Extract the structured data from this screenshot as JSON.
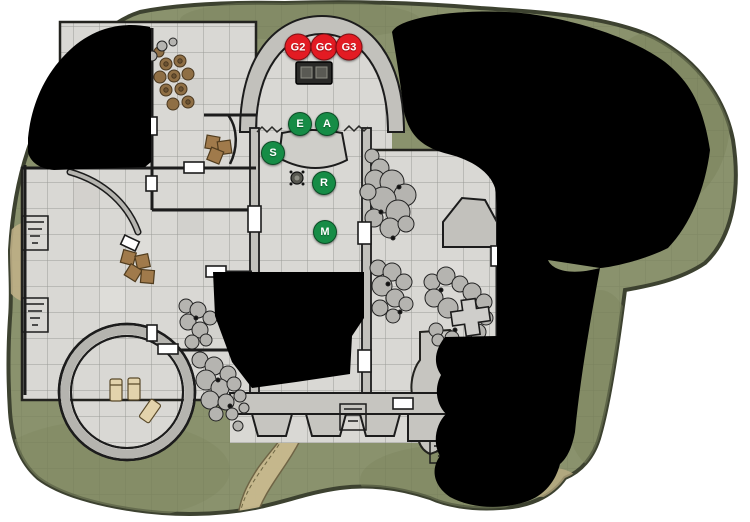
{
  "map": {
    "kind": "vtt-battle-map",
    "colors": {
      "fog": "#000000",
      "grass": "#8a926d",
      "stone": "#d9d8d4",
      "wall": "#1c1c1c",
      "trail": "#c9ba8f",
      "enemy_token": "#e31b23",
      "party_token": "#168c46"
    },
    "tokens": {
      "list": [
        {
          "label": "G2",
          "x": 298,
          "y": 47,
          "d": 25,
          "color": "#e31b23"
        },
        {
          "label": "GC",
          "x": 324,
          "y": 47,
          "d": 25,
          "color": "#e31b23"
        },
        {
          "label": "G3",
          "x": 349,
          "y": 47,
          "d": 25,
          "color": "#e31b23"
        },
        {
          "label": "E",
          "x": 300,
          "y": 124,
          "d": 22,
          "color": "#168c46"
        },
        {
          "label": "A",
          "x": 327,
          "y": 124,
          "d": 22,
          "color": "#168c46"
        },
        {
          "label": "S",
          "x": 273,
          "y": 153,
          "d": 22,
          "color": "#168c46"
        },
        {
          "label": "R",
          "x": 324,
          "y": 183,
          "d": 22,
          "color": "#168c46"
        },
        {
          "label": "M",
          "x": 325,
          "y": 232,
          "d": 22,
          "color": "#168c46"
        }
      ]
    }
  }
}
